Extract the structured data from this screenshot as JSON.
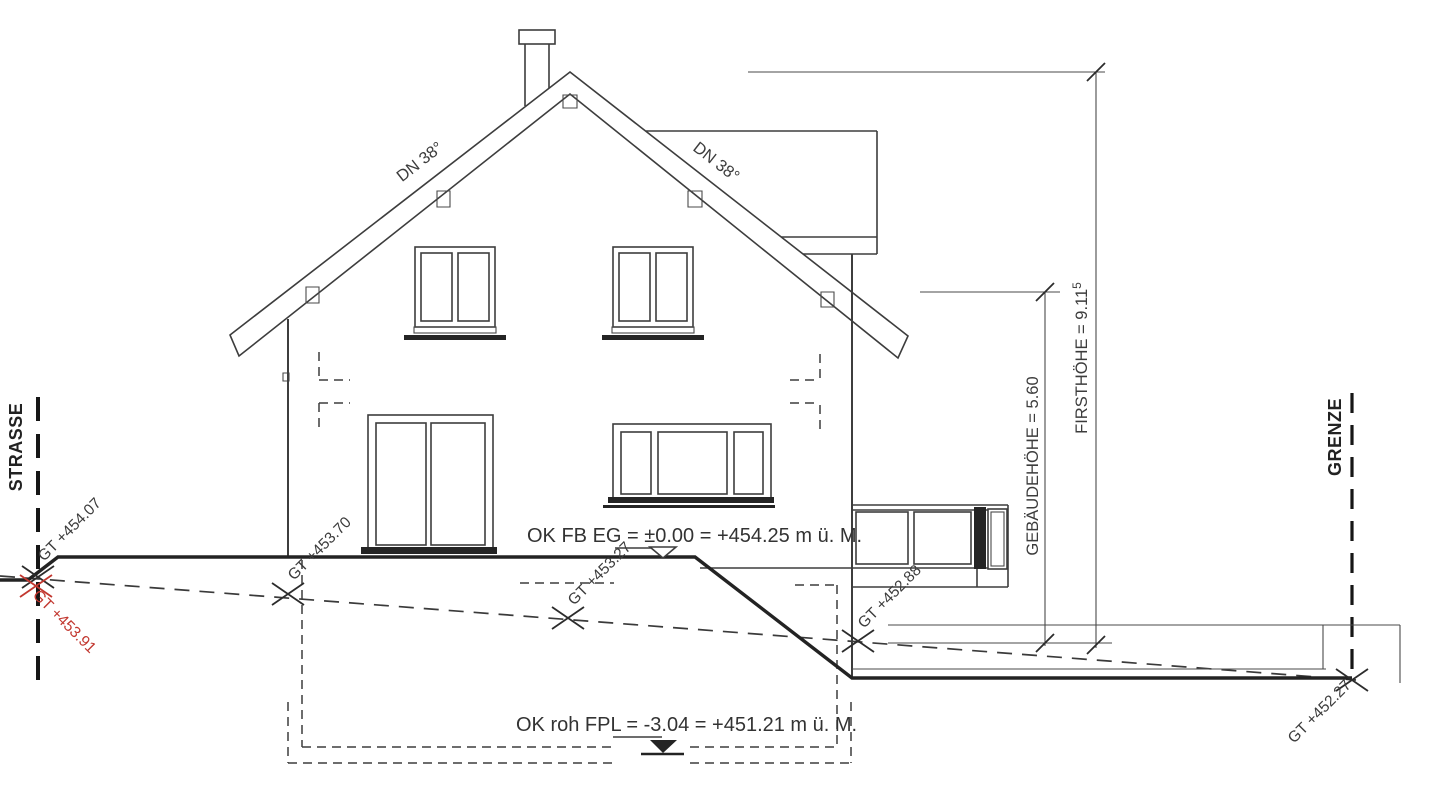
{
  "boundaries": {
    "left": "STRASSE",
    "right": "GRENZE"
  },
  "roof": {
    "pitch_left": "DN 38°",
    "pitch_right": "DN 38°"
  },
  "heights": {
    "ridge": "FIRSTHÖHE = 9.11",
    "ridge_sup": "5",
    "building": "GEBÄUDEHÖHE = 5.60"
  },
  "levels": {
    "ground_floor": "OK FB EG = ±0.00 = +454.25 m ü. M.",
    "foundation": "OK roh FPL = -3.04 = +451.21 m ü. M."
  },
  "terrain": {
    "strasse_planned": "GT +454.07",
    "strasse_existing": "GT +453.91",
    "house_left": "GT +453.70",
    "house_mid": "GT +453.27",
    "house_right": "GT +452.88",
    "grenze": "GT +452.27"
  },
  "colors": {
    "line": "#3d3d3d",
    "marker_red": "#c2372f",
    "background": "#ffffff"
  }
}
